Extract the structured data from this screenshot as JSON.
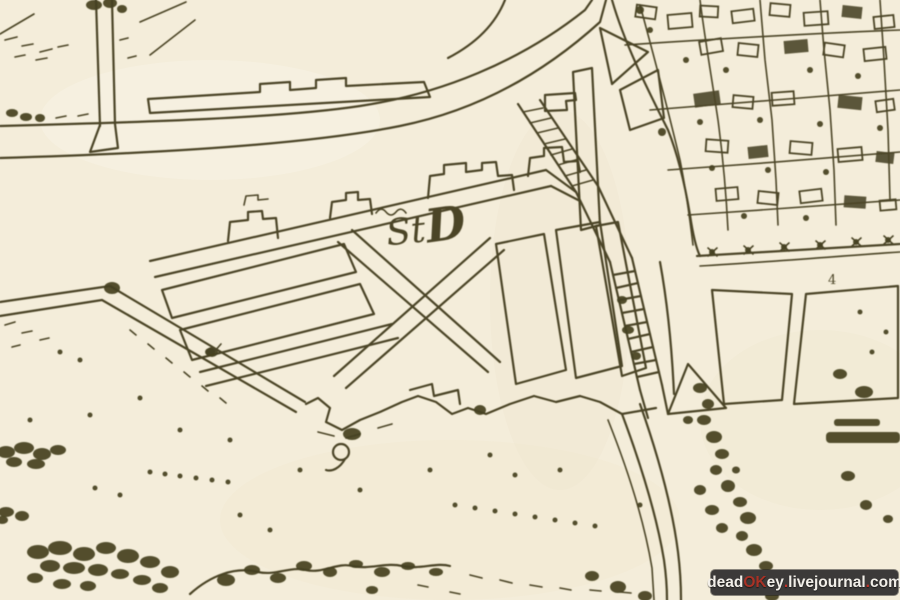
{
  "map": {
    "script_label_small": "St",
    "script_label_large": "D",
    "plot_number": "4",
    "colors": {
      "paper": "#f4edda",
      "ink": "#4b4527",
      "vegetation": "#44411f",
      "shade": "#ece1c8"
    }
  },
  "watermark": {
    "parts": [
      {
        "text": "dead"
      },
      {
        "text": "OK"
      },
      {
        "text": "ey"
      },
      {
        "text": "."
      },
      {
        "text": "livejournal"
      },
      {
        "text": "."
      },
      {
        "text": "com"
      }
    ],
    "colors": {
      "bg": "#3c3a39",
      "text": "#f2efe9",
      "accent": "#a83226",
      "accent2": "#c5342a"
    }
  }
}
